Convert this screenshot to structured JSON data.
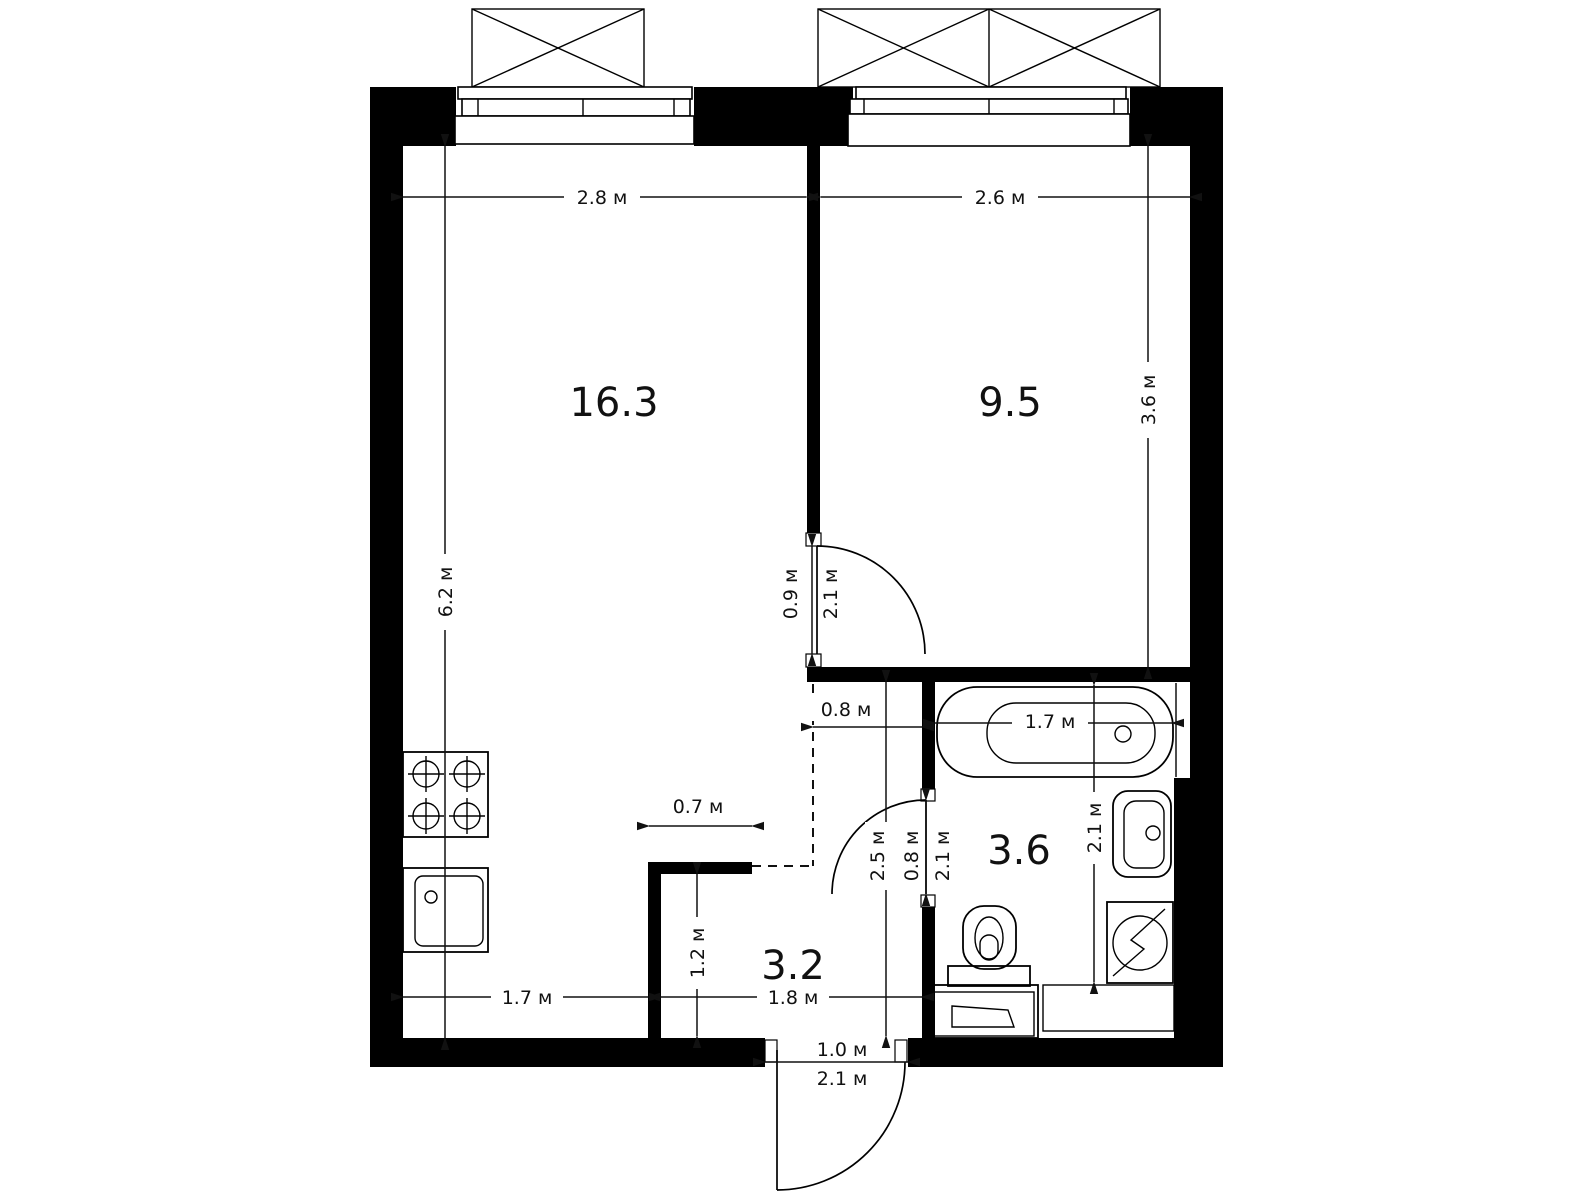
{
  "page": {
    "background": "#ffffff",
    "ink": "#000000"
  },
  "plan": {
    "unit_suffix": "м",
    "rooms": [
      {
        "id": "living-kitchen",
        "area_label": "16.3"
      },
      {
        "id": "bedroom",
        "area_label": "9.5"
      },
      {
        "id": "bathroom",
        "area_label": "3.6"
      },
      {
        "id": "hallway",
        "area_label": "3.2"
      }
    ],
    "dimensions": {
      "living_width": "2.8 м",
      "bedroom_width": "2.6 м",
      "living_height": "6.2 м",
      "bedroom_height": "3.6 м",
      "room_door_width": "0.9 м",
      "room_door_height": "2.1 м",
      "hall_top_width": "0.8 м",
      "bathtub_length": "1.7 м",
      "bathroom_depth": "2.1 м",
      "hall_depth": "2.5 м",
      "bath_door_width": "0.8 м",
      "bath_door_height": "2.1 м",
      "kitchen_stub_width": "0.7 м",
      "stub_height": "1.2 м",
      "kitchen_width": "1.7 м",
      "hall_width": "1.8 м",
      "entry_door_width": "1.0 м",
      "entry_door_height": "2.1 м"
    },
    "fixture_icons": [
      "stove-4-burner-icon",
      "kitchen-sink-icon",
      "bathtub-icon",
      "washbasin-icon",
      "washing-machine-icon",
      "toilet-icon",
      "access-hatch-icon",
      "balcony-box-icon"
    ],
    "window_count": 2
  }
}
